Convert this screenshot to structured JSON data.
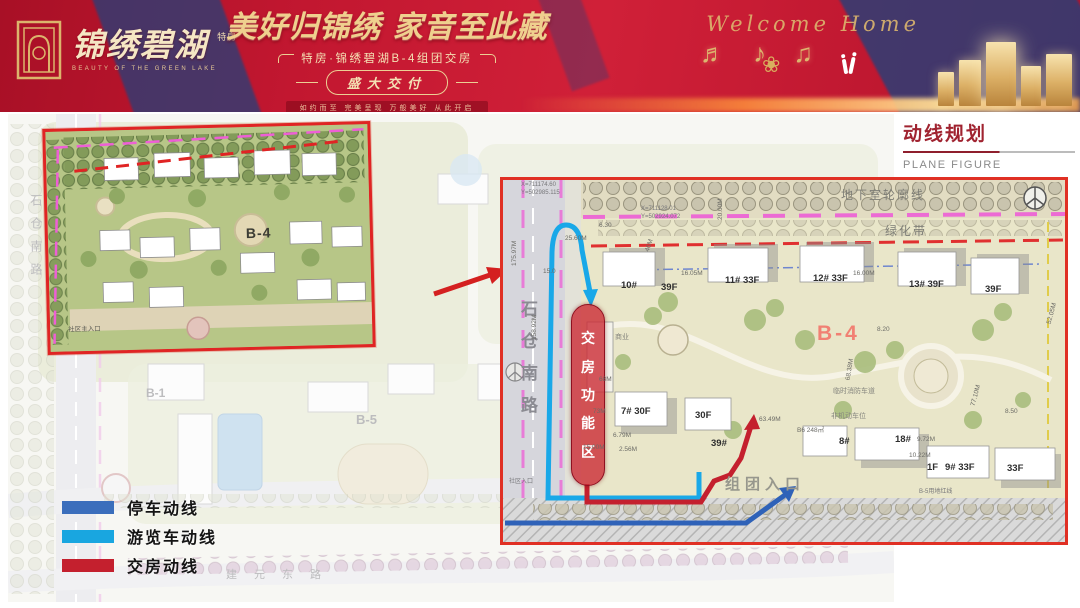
{
  "banner": {
    "brand_cn": "锦绣碧湖",
    "brand_tag": "特房",
    "brand_en": "BEAUTY OF THE GREEN LAKE",
    "headline": "美好归锦绣 家音至此藏",
    "subtitle": "特房·锦绣碧湖B-4组团交房",
    "badge": "盛大交付",
    "tagline": "如约而至 完美呈现 万般美好 从此开启",
    "script_text": "Welcome Home",
    "music_notes": "♬ ♪ ♫",
    "ornament": "❀"
  },
  "title_block": {
    "title": "动线规划",
    "subtitle": "PLANE FIGURE"
  },
  "legend": {
    "items": [
      {
        "label": "停车动线",
        "color": "#3b6ebc"
      },
      {
        "label": "游览车动线",
        "color": "#19a6e0"
      },
      {
        "label": "交房动线",
        "color": "#c4202e"
      }
    ]
  },
  "overview_map": {
    "b1": "B-1",
    "b5": "B-5",
    "road_bottom": "建元东路",
    "road_left": "石仓南路"
  },
  "inset_map": {
    "zone": "B-4",
    "entrance": "社区主入口"
  },
  "detail_map": {
    "zone": "B-4",
    "handover_chars": {
      "c1": "交",
      "c2": "房",
      "c3": "功",
      "c4": "能",
      "c5": "区"
    },
    "road_left": "石仓南路",
    "basement_outline": "地下室轮廓线",
    "green_belt": "绿化带",
    "fire_lane": "临时消防车道",
    "non_motor_parking": "非机动车位",
    "commerce": "商业",
    "group_entrance": "组团入口",
    "community_entrance": "社区入口",
    "b5_boundary": "B-5用地红线",
    "buildings": {
      "b10": "10#",
      "b10f": "39F",
      "b11": "11# 33F",
      "b12": "12# 33F",
      "b13": "13# 39F",
      "b13f": "39F",
      "b7": "7# 30F",
      "b7f": "30F",
      "b8": "8#",
      "b18": "18#",
      "b39": "39#",
      "b9": "9# 33F",
      "b9f": "33F",
      "b1f": "1F"
    },
    "dims": {
      "d1": "175.97M",
      "d2": "158.92M",
      "d3": "25.60M",
      "d4": "15.00M",
      "d5": "2.56M",
      "d6": "68M",
      "d7": "73M",
      "d8": "6.79M",
      "d9": "8.20",
      "d10": "68.38M",
      "d11": "77.10M",
      "d12": "63.49M",
      "d13": "8.50",
      "d14": "10.22M",
      "d15": "9.72M",
      "d16": "16.00M",
      "d17": "16.05M",
      "d18": "20.00M",
      "d19": "46M",
      "d20": "6.30",
      "d21": "B6 248㎡",
      "d22": "52.05M",
      "d23": "15.0"
    },
    "coords": {
      "c1": "X=711128.01",
      "c2": "Y=502924.072",
      "c3": "X=711174.60",
      "c4": "Y=502985.115"
    }
  }
}
